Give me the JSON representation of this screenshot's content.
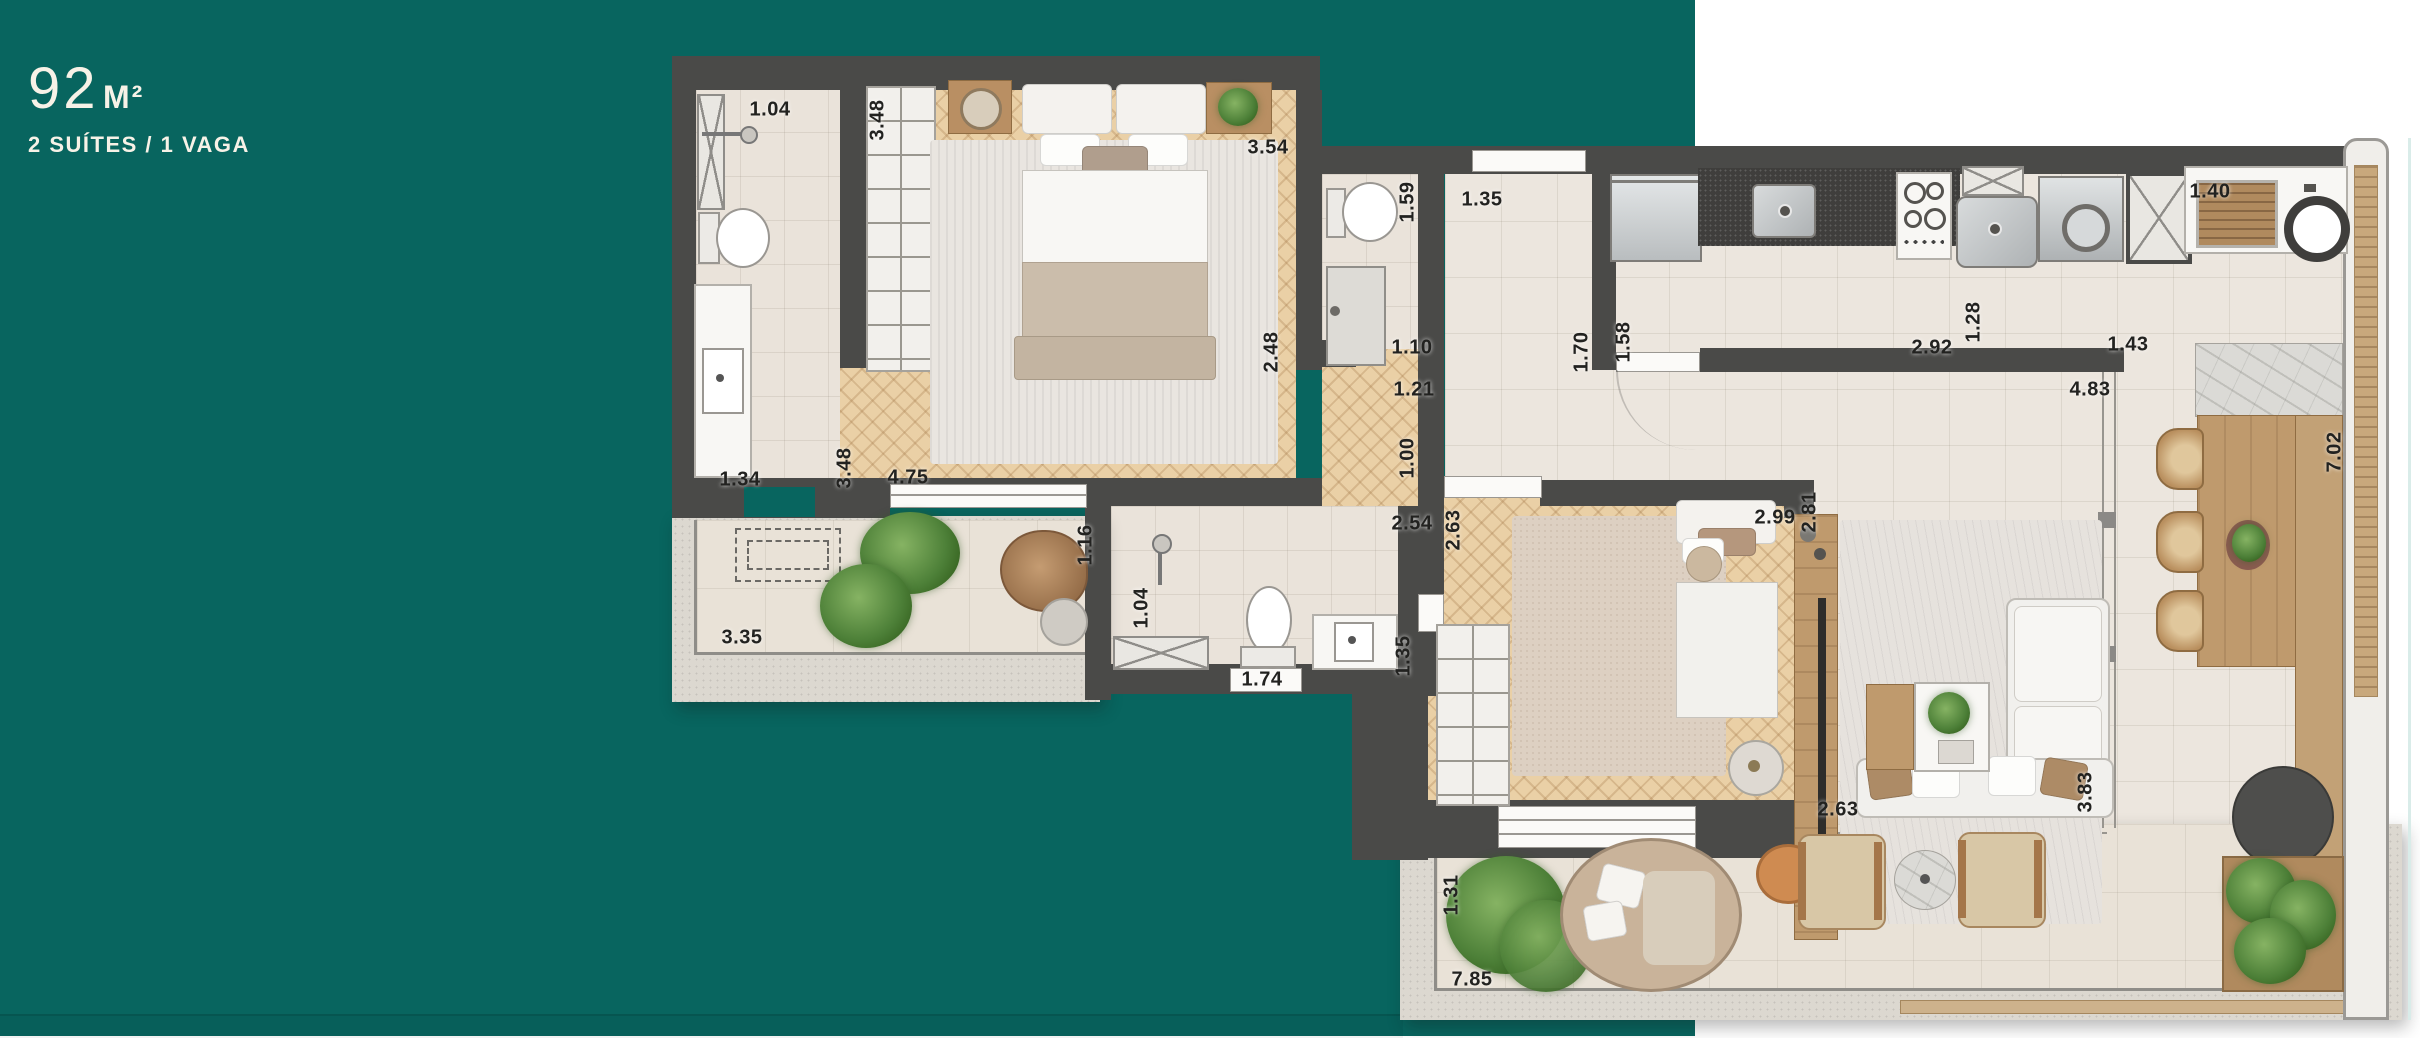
{
  "header": {
    "area_value": "92",
    "area_unit": "M²",
    "subtitle": "2 SUÍTES / 1 VAGA"
  },
  "colors": {
    "background_teal": "#08655f",
    "background_white": "#ffffff",
    "wall": "#4a4a48",
    "wood_floor": "#ead0a6",
    "tile_floor": "#ece6de",
    "title_text": "#f7f2e7",
    "dimension_text": "#222220"
  },
  "floorplan": {
    "dimensions": [
      {
        "text": "1.04",
        "x": 770,
        "y": 110,
        "rot": false
      },
      {
        "text": "3.48",
        "x": 878,
        "y": 120,
        "rot": true
      },
      {
        "text": "3.54",
        "x": 1268,
        "y": 148,
        "rot": false
      },
      {
        "text": "1.59",
        "x": 1408,
        "y": 202,
        "rot": true
      },
      {
        "text": "1.35",
        "x": 1482,
        "y": 200,
        "rot": false
      },
      {
        "text": "1.34",
        "x": 740,
        "y": 480,
        "rot": false
      },
      {
        "text": "3.48",
        "x": 845,
        "y": 468,
        "rot": true
      },
      {
        "text": "4.75",
        "x": 908,
        "y": 478,
        "rot": false
      },
      {
        "text": "2.48",
        "x": 1272,
        "y": 352,
        "rot": true
      },
      {
        "text": "1.10",
        "x": 1412,
        "y": 348,
        "rot": false
      },
      {
        "text": "1.21",
        "x": 1414,
        "y": 390,
        "rot": false
      },
      {
        "text": "1.00",
        "x": 1408,
        "y": 458,
        "rot": true
      },
      {
        "text": "1.70",
        "x": 1582,
        "y": 352,
        "rot": true
      },
      {
        "text": "1.58",
        "x": 1624,
        "y": 342,
        "rot": true
      },
      {
        "text": "2.92",
        "x": 1932,
        "y": 348,
        "rot": false
      },
      {
        "text": "1.28",
        "x": 1974,
        "y": 322,
        "rot": true
      },
      {
        "text": "1.43",
        "x": 2128,
        "y": 345,
        "rot": false
      },
      {
        "text": "4.83",
        "x": 2090,
        "y": 390,
        "rot": false
      },
      {
        "text": "1.40",
        "x": 2210,
        "y": 192,
        "rot": false
      },
      {
        "text": "7.02",
        "x": 2335,
        "y": 452,
        "rot": true
      },
      {
        "text": "3.35",
        "x": 742,
        "y": 638,
        "rot": false
      },
      {
        "text": "1.16",
        "x": 1086,
        "y": 545,
        "rot": true
      },
      {
        "text": "1.04",
        "x": 1142,
        "y": 608,
        "rot": true
      },
      {
        "text": "2.54",
        "x": 1412,
        "y": 524,
        "rot": false
      },
      {
        "text": "1.74",
        "x": 1262,
        "y": 680,
        "rot": false
      },
      {
        "text": "1.35",
        "x": 1404,
        "y": 656,
        "rot": true
      },
      {
        "text": "2.63",
        "x": 1454,
        "y": 530,
        "rot": true
      },
      {
        "text": "2.99",
        "x": 1775,
        "y": 518,
        "rot": false
      },
      {
        "text": "2.81",
        "x": 1810,
        "y": 512,
        "rot": true
      },
      {
        "text": "2.63",
        "x": 1838,
        "y": 810,
        "rot": false
      },
      {
        "text": "3.83",
        "x": 2086,
        "y": 792,
        "rot": true
      },
      {
        "text": "1.31",
        "x": 1452,
        "y": 895,
        "rot": true
      },
      {
        "text": "7.85",
        "x": 1472,
        "y": 980,
        "rot": false
      }
    ]
  }
}
